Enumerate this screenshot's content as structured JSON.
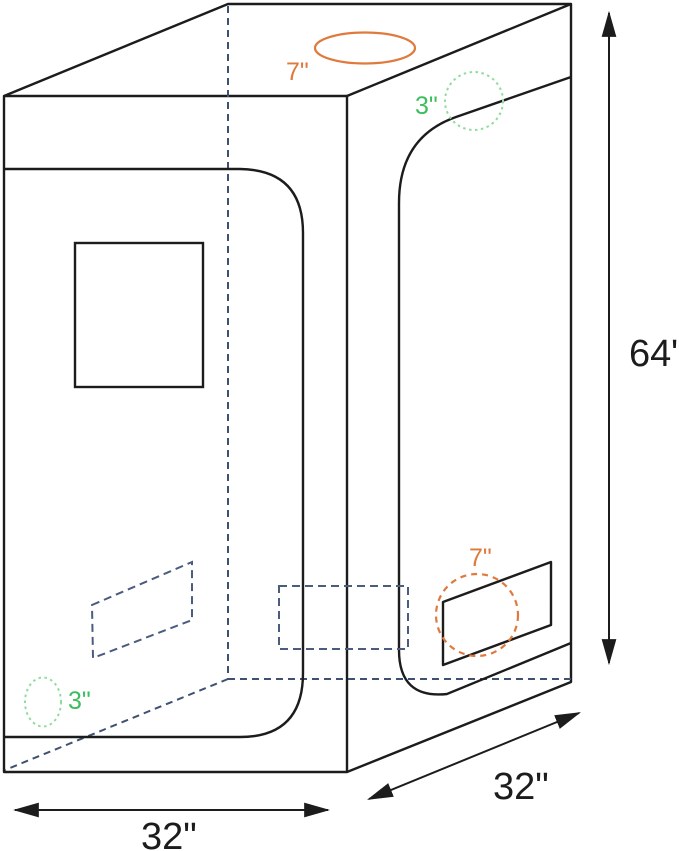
{
  "diagram": {
    "name": "grow-tent-dimension-diagram",
    "dimensions": {
      "height": "64\"",
      "width": "32\"",
      "depth": "32\""
    },
    "ports": {
      "top_duct": "7\"",
      "top_cord": "3\"",
      "side_duct": "7\"",
      "floor_cord": "3\""
    },
    "colors": {
      "outline": "#1c1c1c",
      "hidden_edge": "#3f5170",
      "vent_dashed": "#4a5d7e",
      "duct_orange": "#e0793c",
      "port_green_text": "#3cbd5e",
      "port_green_stroke": "#8fdc9e"
    }
  }
}
